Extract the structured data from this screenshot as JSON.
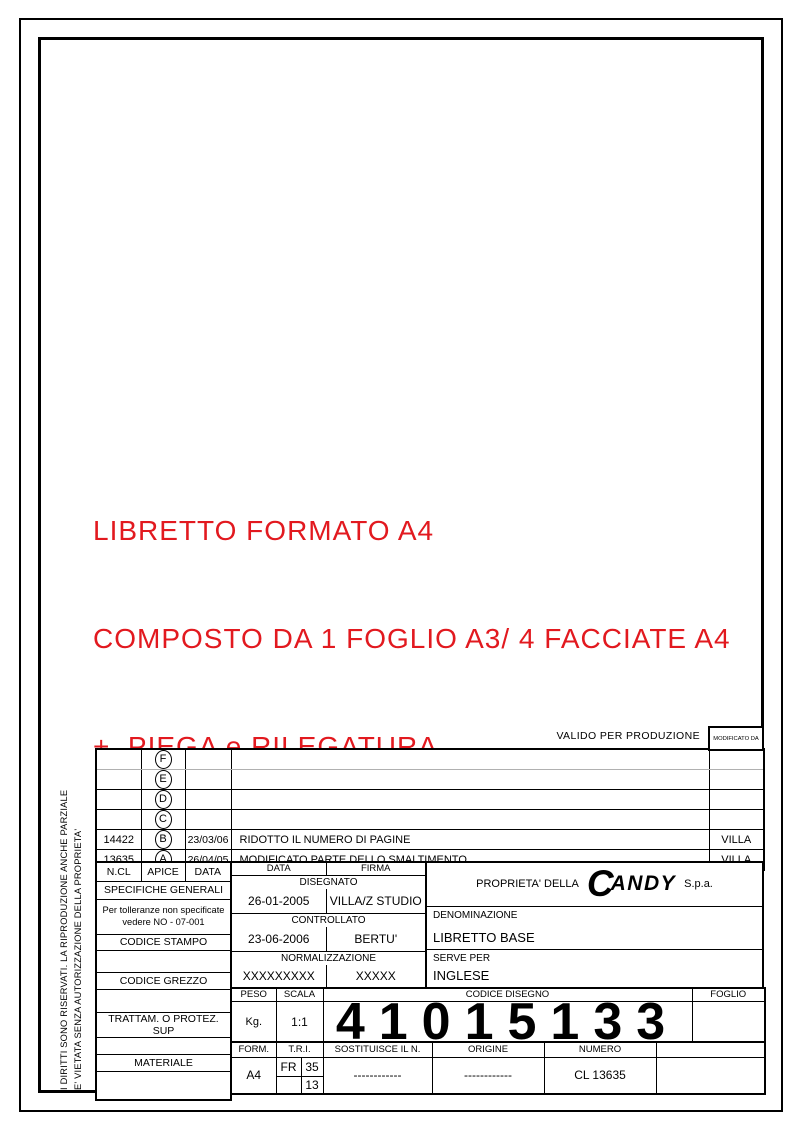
{
  "colors": {
    "accent_red": "#e2191f"
  },
  "red_notice": {
    "line1": "LIBRETTO FORMATO A4",
    "line2": "COMPOSTO DA 1 FOGLIO A3/ 4 FACCIATE A4",
    "line3": "+  PIEGA e RILEGATURA"
  },
  "disclaimer": {
    "line1": "I DIRITTI SONO RISERVATI. LA RIPRODUZIONE ANCHE PARZIALE",
    "line2": "E' VIETATA SENZA AUTORIZZAZIONE DELLA PROPRIETA'"
  },
  "valido_label": "VALIDO PER PRODUZIONE",
  "revisions": {
    "modificato_da_label": "MODIFICATO DA",
    "header": {
      "ncl": "N.CL",
      "apice": "APICE",
      "data": "DATA"
    },
    "rows": [
      {
        "ncl": "",
        "apice": "F",
        "date": "",
        "desc": "",
        "by": ""
      },
      {
        "ncl": "",
        "apice": "E",
        "date": "",
        "desc": "",
        "by": ""
      },
      {
        "ncl": "",
        "apice": "D",
        "date": "",
        "desc": "",
        "by": ""
      },
      {
        "ncl": "",
        "apice": "C",
        "date": "",
        "desc": "",
        "by": ""
      },
      {
        "ncl": "14422",
        "apice": "B",
        "date": "23/03/06",
        "desc": "RIDOTTO IL NUMERO DI PAGINE",
        "by": "VILLA"
      },
      {
        "ncl": "13635",
        "apice": "A",
        "date": "26/04/05",
        "desc": "MODIFICATO PARTE DELLO SMALTIMENTO",
        "by": "VILLA"
      }
    ]
  },
  "titleblock": {
    "specifiche_label": "SPECIFICHE GENERALI",
    "tolleranze_line1": "Per tolleranze non specificate",
    "tolleranze_line2": "vedere NO - 07-001",
    "codice_stampo_label": "CODICE STAMPO",
    "codice_grezzo_label": "CODICE GREZZO",
    "trattam_label": "TRATTAM. O PROTEZ. SUP",
    "materiale_label": "MATERIALE",
    "data_label": "DATA",
    "firma_label": "FIRMA",
    "disegnato_label": "DISEGNATO",
    "disegnato_date": "26-01-2005",
    "disegnato_firma": "VILLA/Z STUDIO",
    "controllato_label": "CONTROLLATO",
    "controllato_date": "23-06-2006",
    "controllato_firma": "BERTU'",
    "normalizzazione_label": "NORMALIZZAZIONE",
    "normalizzazione_date": "XXXXXXXXX",
    "normalizzazione_firma": "XXXXX",
    "proprieta_label": "PROPRIETA' DELLA",
    "brand_c": "C",
    "brand_rest": "ANDY",
    "spa_label": "S.p.a.",
    "denominazione_label": "DENOMINAZIONE",
    "denominazione_value": "LIBRETTO BASE",
    "serve_per_label": "SERVE PER",
    "serve_per_value": "INGLESE",
    "peso_label": "PESO",
    "peso_value": "Kg.",
    "scala_label": "SCALA",
    "scala_value": "1:1",
    "codice_disegno_label": "CODICE DISEGNO",
    "codice_disegno_value": "41015133",
    "foglio_label": "FOGLIO",
    "form_label": "FORM.",
    "form_value": "A4",
    "tri_label": "T.R.I.",
    "tri_fr": "FR",
    "tri_35": "35",
    "tri_13": "13",
    "sostituisce_label": "SOSTITUISCE IL N.",
    "sostituisce_value": "------------",
    "origine_label": "ORIGINE",
    "origine_value": "------------",
    "numero_label": "NUMERO",
    "numero_value": "CL 13635"
  }
}
